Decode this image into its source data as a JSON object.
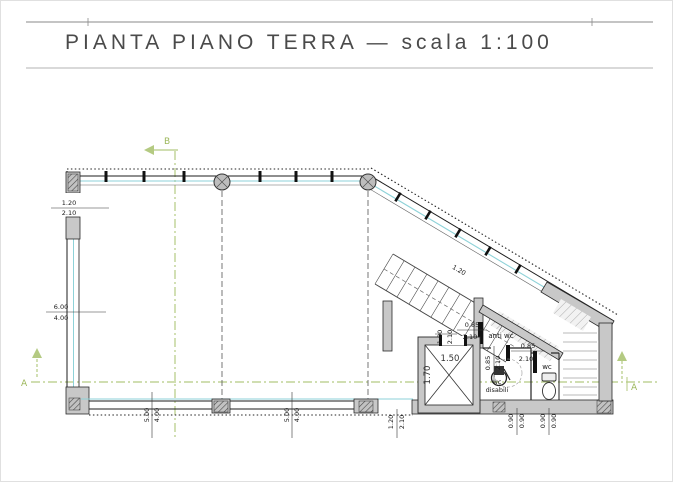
{
  "title": {
    "text": "PIANTA PIANO TERRA — scala 1:100"
  },
  "sections": {
    "a_left": "A",
    "a_right": "A",
    "b": "B"
  },
  "rooms": {
    "anti_wc": "anti wc",
    "wc": "wc",
    "wc_disabili_line1": "wc",
    "wc_disabili_line2": "disabili"
  },
  "elevator": {
    "width": "1.50",
    "depth": "1.70"
  },
  "stairs": {
    "flight_width": "1.20"
  },
  "dimensions": {
    "left_door": {
      "w": "1.20",
      "h": "2.10"
    },
    "left_wall": {
      "a": "6.00",
      "b": "4.00"
    },
    "bottom_bay_1": {
      "a": "5.00",
      "b": "4.00"
    },
    "bottom_bay_2": {
      "a": "5.00",
      "b": "4.00"
    },
    "bottom_door": {
      "w": "1.20",
      "h": "2.10"
    },
    "lobby_door": {
      "w": "1.00",
      "h": "2.10"
    },
    "anti_wc_door": {
      "w": "0.85",
      "h": "2.10"
    },
    "wc_door": {
      "w": "0.85",
      "h": "2.10"
    },
    "inner_door": {
      "w": "0.85",
      "h": "2.10"
    },
    "wc_disabili_width": {
      "a": "0.90",
      "b": "0.90"
    },
    "wc_width": {
      "a": "0.90",
      "b": "0.90"
    }
  },
  "colors": {
    "section_green": "#b4ca82",
    "glass_cyan": "#8ed2d8",
    "wall_gray": "#c8c8c8",
    "line_black": "#1c1c1c"
  }
}
